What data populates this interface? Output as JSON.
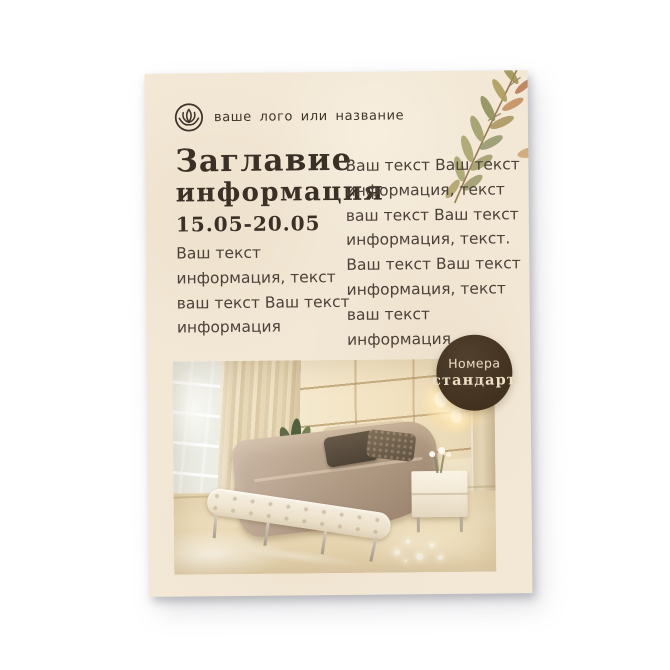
{
  "flyer": {
    "logo": {
      "text": "ваше лого или название",
      "icon": "lotus-icon"
    },
    "title_line1": "Заглавие",
    "title_line2": "информация",
    "date_range": "15.05-20.05",
    "left_column_lines": [
      "Ваш текст",
      "информация, текст",
      "ваш текст  Ваш текст",
      "информация"
    ],
    "right_column_lines": [
      "Ваш текст Ваш текст",
      "информация, текст",
      "ваш текст  Ваш текст",
      "информация, текст.",
      "Ваш текст  Ваш текст",
      "информация, текст",
      "ваш текст",
      "информация,"
    ],
    "badge": {
      "line1": "Номера",
      "line2": "стандарт"
    },
    "colors": {
      "paper": "#f3e8d6",
      "title_text": "#3b3026",
      "body_text": "#4b4138",
      "badge_background": "#47352a",
      "badge_text": "#ecdfc4",
      "leaf_olive": "#9d9a62",
      "leaf_rust": "#b5764d"
    }
  }
}
